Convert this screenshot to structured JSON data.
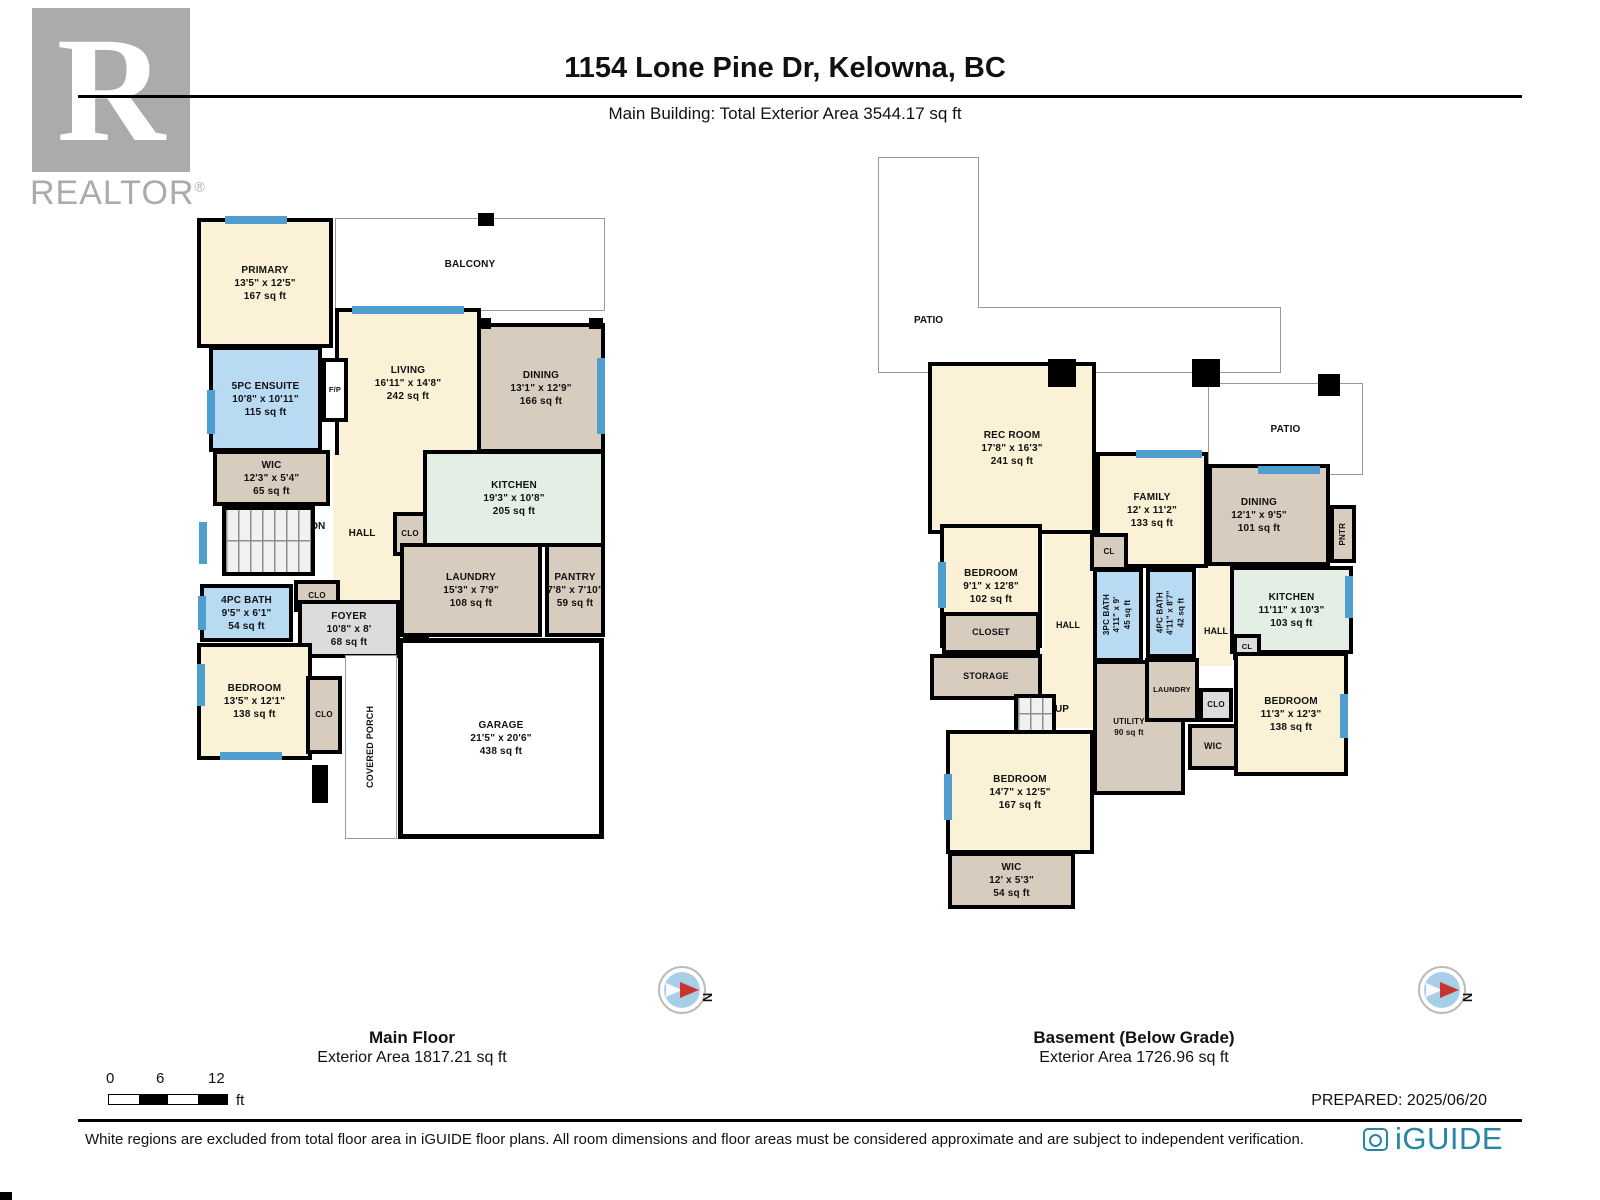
{
  "header": {
    "logo_r": "R",
    "logo_text": "REALTOR",
    "logo_reg": "®",
    "title": "1154 Lone Pine Dr, Kelowna, BC",
    "subtitle": "Main Building: Total Exterior Area 3544.17 sq ft"
  },
  "colors": {
    "wall": "#000000",
    "window_blue": "#4e9fd0",
    "room_cream": "#faf1d6",
    "room_tan": "#d8ccbe",
    "room_blue": "#b9daf3",
    "room_green": "#e3eee5",
    "room_grey": "#dcdcdc",
    "brand_blue": "#2786a8",
    "compass_red": "#c9352b",
    "logo_grey": "#ababab"
  },
  "main_floor": {
    "caption_title": "Main Floor",
    "caption_subtitle": "Exterior Area 1817.21 sq ft",
    "rooms": {
      "primary": {
        "name": "PRIMARY",
        "dims": "13'5\" x 12'5\"",
        "area": "167 sq ft"
      },
      "balcony": {
        "name": "BALCONY"
      },
      "ensuite": {
        "name": "5PC ENSUITE",
        "dims": "10'8\" x 10'11\"",
        "area": "115 sq ft"
      },
      "fp": {
        "name": "F/P"
      },
      "living": {
        "name": "LIVING",
        "dims": "16'11\" x 14'8\"",
        "area": "242 sq ft"
      },
      "dining": {
        "name": "DINING",
        "dims": "13'1\" x 12'9\"",
        "area": "166 sq ft"
      },
      "kitchen": {
        "name": "KITCHEN",
        "dims": "19'3\" x 10'8\"",
        "area": "205 sq ft"
      },
      "wic": {
        "name": "WIC",
        "dims": "12'3\" x 5'4\"",
        "area": "65 sq ft"
      },
      "dn": {
        "name": "DN"
      },
      "hall": {
        "name": "HALL"
      },
      "clo_hall": {
        "name": "CLO"
      },
      "bath": {
        "name": "4PC BATH",
        "dims": "9'5\" x 6'1\"",
        "area": "54 sq ft"
      },
      "clo_bath": {
        "name": "CLO"
      },
      "foyer": {
        "name": "FOYER",
        "dims": "10'8\" x 8'",
        "area": "68 sq ft"
      },
      "cl": {
        "name": "CL"
      },
      "laundry": {
        "name": "LAUNDRY",
        "dims": "15'3\" x 7'9\"",
        "area": "108 sq ft"
      },
      "pantry": {
        "name": "PANTRY",
        "dims": "7'8\" x 7'10\"",
        "area": "59 sq ft"
      },
      "bedroom": {
        "name": "BEDROOM",
        "dims": "13'5\" x 12'1\"",
        "area": "138 sq ft"
      },
      "clo_bedroom": {
        "name": "CLO"
      },
      "porch": {
        "name": "COVERED PORCH"
      },
      "garage": {
        "name": "GARAGE",
        "dims": "21'5\" x 20'6\"",
        "area": "438 sq ft"
      }
    }
  },
  "basement": {
    "caption_title": "Basement (Below Grade)",
    "caption_subtitle": "Exterior Area 1726.96 sq ft",
    "rooms": {
      "patio1": {
        "name": "PATIO"
      },
      "patio2": {
        "name": "PATIO"
      },
      "rec": {
        "name": "REC ROOM",
        "dims": "17'8\" x 16'3\"",
        "area": "241 sq ft"
      },
      "family": {
        "name": "FAMILY",
        "dims": "12' x 11'2\"",
        "area": "133 sq ft"
      },
      "dining": {
        "name": "DINING",
        "dims": "12'1\" x 9'5\"",
        "area": "101 sq ft"
      },
      "pntr": {
        "name": "PNTR"
      },
      "bedroom1": {
        "name": "BEDROOM",
        "dims": "9'1\" x 12'8\"",
        "area": "102 sq ft"
      },
      "cl1": {
        "name": "CL"
      },
      "bath3": {
        "name": "3PC BATH",
        "dims": "4'11\" x 9'",
        "area": "45 sq ft"
      },
      "bath4": {
        "name": "4PC BATH",
        "dims": "4'11\" x 8'7\"",
        "area": "42 sq ft"
      },
      "hall_left": {
        "name": "HALL"
      },
      "hall_right": {
        "name": "HALL"
      },
      "kitchen": {
        "name": "KITCHEN",
        "dims": "11'11\" x 10'3\"",
        "area": "103 sq ft"
      },
      "cl2": {
        "name": "CL"
      },
      "closet": {
        "name": "CLOSET"
      },
      "storage": {
        "name": "STORAGE"
      },
      "up": {
        "name": "UP"
      },
      "utility": {
        "name": "UTILITY",
        "area": "90 sq ft"
      },
      "laundry": {
        "name": "LAUNDRY"
      },
      "clo": {
        "name": "CLO"
      },
      "wic_mid": {
        "name": "WIC"
      },
      "bedroom2": {
        "name": "BEDROOM",
        "dims": "11'3\" x 12'3\"",
        "area": "138 sq ft"
      },
      "bedroom3": {
        "name": "BEDROOM",
        "dims": "14'7\" x 12'5\"",
        "area": "167 sq ft"
      },
      "wic": {
        "name": "WIC",
        "dims": "12' x 5'3\"",
        "area": "54 sq ft"
      }
    }
  },
  "compass": {
    "north_label": "N"
  },
  "scale_bar": {
    "tick0": "0",
    "tick1": "6",
    "tick2": "12",
    "unit": "ft"
  },
  "footer": {
    "prepared": "PREPARED: 2025/06/20",
    "disclaimer": "White regions are excluded from total floor area in iGUIDE floor plans. All room dimensions and floor areas must be considered approximate and are subject to independent verification.",
    "brand": "iGUIDE"
  }
}
